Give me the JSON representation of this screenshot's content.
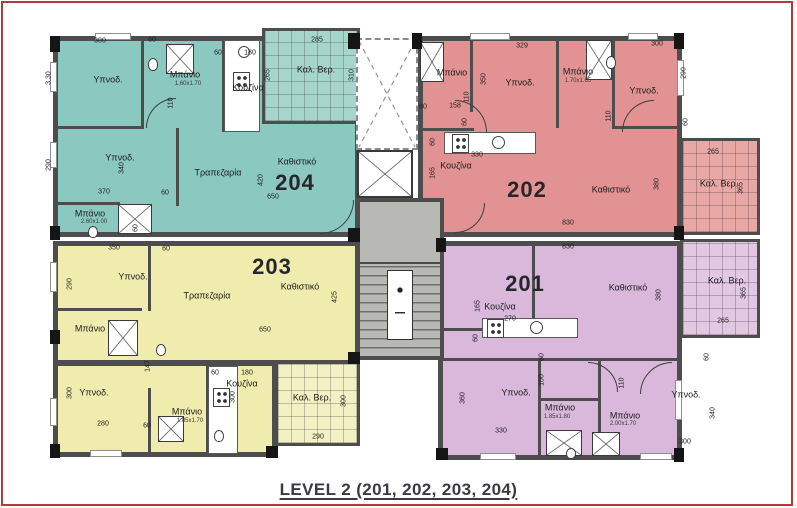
{
  "title": "LEVEL 2 (201, 202, 203, 204)",
  "colors": {
    "apt_204": "#8ac8c0",
    "bal_204": "#a6d5cb",
    "apt_202": "#e29292",
    "bal_202": "#e9a8a6",
    "apt_203": "#f0ecae",
    "bal_203": "#f3f0c4",
    "apt_201": "#d9b8db",
    "bal_201": "#e2c8e3",
    "wall": "#4d4d4d",
    "core": "#b8b8b4",
    "frame": "#b23a3a"
  },
  "apartments": [
    {
      "number": "204",
      "rooms": [
        "Υπνοδ.",
        "Υπνοδ.",
        "Μπάνιο",
        "Μπάνιο",
        "Κουζίνα",
        "Τραπεζαρία",
        "Καθιστικό",
        "Καλ. Βερ."
      ]
    },
    {
      "number": "202",
      "rooms": [
        "Μπάνιο",
        "Υπνοδ.",
        "Μπάνιο",
        "Υπνοδ.",
        "Κουζίνα",
        "Καθιστικό",
        "Καλ. Βερ."
      ]
    },
    {
      "number": "203",
      "rooms": [
        "Υπνοδ.",
        "Τραπεζαρία",
        "Καθιστικό",
        "Μπάνιο",
        "Υπνοδ.",
        "Μπάνιο",
        "Κουζίνα",
        "Καλ. Βερ."
      ]
    },
    {
      "number": "201",
      "rooms": [
        "Κουζίνα",
        "Καθιστικό",
        "Υπνοδ.",
        "Μπάνιο",
        "Μπάνιο",
        "Υπνοδ.",
        "Καλ. Βερ."
      ]
    }
  ],
  "labels": [
    {
      "t": "204",
      "x": 295,
      "y": 183,
      "c": "num"
    },
    {
      "t": "202",
      "x": 527,
      "y": 190,
      "c": "num"
    },
    {
      "t": "203",
      "x": 272,
      "y": 267,
      "c": "num"
    },
    {
      "t": "201",
      "x": 525,
      "y": 284,
      "c": "num"
    },
    {
      "t": "Υπνοδ.",
      "x": 108,
      "y": 80,
      "c": "room"
    },
    {
      "t": "Υπνοδ.",
      "x": 120,
      "y": 158,
      "c": "room"
    },
    {
      "t": "Μπάνιο",
      "x": 185,
      "y": 75,
      "c": "room"
    },
    {
      "t": "1.60x1.70",
      "x": 188,
      "y": 84,
      "c": "sub"
    },
    {
      "t": "Κουζίνα",
      "x": 248,
      "y": 88,
      "c": "room"
    },
    {
      "t": "Τραπεζαρία",
      "x": 218,
      "y": 173,
      "c": "room"
    },
    {
      "t": "Καθιστικό",
      "x": 297,
      "y": 162,
      "c": "room"
    },
    {
      "t": "Μπάνιο",
      "x": 90,
      "y": 214,
      "c": "room"
    },
    {
      "t": "2.60x1.00",
      "x": 94,
      "y": 222,
      "c": "sub"
    },
    {
      "t": "Καλ. Βερ.",
      "x": 316,
      "y": 70,
      "c": "room"
    },
    {
      "t": "Μπάνιο",
      "x": 452,
      "y": 73,
      "c": "room"
    },
    {
      "t": "Υπνοδ.",
      "x": 520,
      "y": 83,
      "c": "room"
    },
    {
      "t": "Μπάνιο",
      "x": 578,
      "y": 72,
      "c": "room"
    },
    {
      "t": "1.70x1.65",
      "x": 578,
      "y": 81,
      "c": "sub"
    },
    {
      "t": "Υπνοδ.",
      "x": 644,
      "y": 91,
      "c": "room"
    },
    {
      "t": "Κουζίνα",
      "x": 456,
      "y": 166,
      "c": "room"
    },
    {
      "t": "Καθιστικό",
      "x": 611,
      "y": 190,
      "c": "room"
    },
    {
      "t": "Καλ. Βερ.",
      "x": 719,
      "y": 184,
      "c": "room"
    },
    {
      "t": "Υπνοδ.",
      "x": 133,
      "y": 277,
      "c": "room"
    },
    {
      "t": "Τραπεζαρία",
      "x": 207,
      "y": 296,
      "c": "room"
    },
    {
      "t": "Καθιστικό",
      "x": 300,
      "y": 287,
      "c": "room"
    },
    {
      "t": "Μπάνιο",
      "x": 90,
      "y": 329,
      "c": "room"
    },
    {
      "t": "Υπνοδ.",
      "x": 94,
      "y": 393,
      "c": "room"
    },
    {
      "t": "Μπάνιο",
      "x": 187,
      "y": 412,
      "c": "room"
    },
    {
      "t": "1.85x1.70",
      "x": 190,
      "y": 421,
      "c": "sub"
    },
    {
      "t": "Κουζίνα",
      "x": 242,
      "y": 384,
      "c": "room"
    },
    {
      "t": "Καλ. Βερ.",
      "x": 312,
      "y": 398,
      "c": "room"
    },
    {
      "t": "Κουζίνα",
      "x": 500,
      "y": 307,
      "c": "room"
    },
    {
      "t": "Καθιστικό",
      "x": 628,
      "y": 288,
      "c": "room"
    },
    {
      "t": "Υπνοδ.",
      "x": 516,
      "y": 393,
      "c": "room"
    },
    {
      "t": "Μπάνιο",
      "x": 560,
      "y": 408,
      "c": "room"
    },
    {
      "t": "1.85x1.80",
      "x": 557,
      "y": 417,
      "c": "sub"
    },
    {
      "t": "Μπάνιο",
      "x": 625,
      "y": 416,
      "c": "room"
    },
    {
      "t": "2.00x1.70",
      "x": 623,
      "y": 424,
      "c": "sub"
    },
    {
      "t": "Υπνοδ.",
      "x": 686,
      "y": 395,
      "c": "room"
    },
    {
      "t": "Καλ. Βερ.",
      "x": 727,
      "y": 281,
      "c": "room"
    },
    {
      "t": "300",
      "x": 100,
      "y": 41,
      "c": "dim"
    },
    {
      "t": "60",
      "x": 152,
      "y": 40,
      "c": "dim"
    },
    {
      "t": "60",
      "x": 218,
      "y": 53,
      "c": "dim"
    },
    {
      "t": "180",
      "x": 250,
      "y": 53,
      "c": "dim"
    },
    {
      "t": "3.30",
      "x": 49,
      "y": 78,
      "c": "dim",
      "r": 1
    },
    {
      "t": "110",
      "x": 171,
      "y": 103,
      "c": "dim",
      "r": 1
    },
    {
      "t": "290",
      "x": 49,
      "y": 165,
      "c": "dim",
      "r": 1
    },
    {
      "t": "340",
      "x": 122,
      "y": 168,
      "c": "dim",
      "r": 1
    },
    {
      "t": "370",
      "x": 104,
      "y": 192,
      "c": "dim"
    },
    {
      "t": "60",
      "x": 165,
      "y": 193,
      "c": "dim"
    },
    {
      "t": "60",
      "x": 136,
      "y": 228,
      "c": "dim",
      "r": 1
    },
    {
      "t": "265",
      "x": 268,
      "y": 75,
      "c": "dim",
      "r": 1
    },
    {
      "t": "285",
      "x": 317,
      "y": 40,
      "c": "dim"
    },
    {
      "t": "310",
      "x": 352,
      "y": 75,
      "c": "dim",
      "r": 1
    },
    {
      "t": "420",
      "x": 261,
      "y": 180,
      "c": "dim",
      "r": 1
    },
    {
      "t": "650",
      "x": 273,
      "y": 197,
      "c": "dim"
    },
    {
      "t": "329",
      "x": 522,
      "y": 46,
      "c": "dim"
    },
    {
      "t": "300",
      "x": 657,
      "y": 44,
      "c": "dim"
    },
    {
      "t": "350",
      "x": 484,
      "y": 79,
      "c": "dim",
      "r": 1
    },
    {
      "t": "110",
      "x": 467,
      "y": 97,
      "c": "dim",
      "r": 1
    },
    {
      "t": "158",
      "x": 455,
      "y": 106,
      "c": "dim"
    },
    {
      "t": "60",
      "x": 423,
      "y": 107,
      "c": "dim"
    },
    {
      "t": "60",
      "x": 465,
      "y": 122,
      "c": "dim",
      "r": 1
    },
    {
      "t": "60",
      "x": 433,
      "y": 142,
      "c": "dim",
      "r": 1
    },
    {
      "t": "330",
      "x": 477,
      "y": 155,
      "c": "dim"
    },
    {
      "t": "165",
      "x": 433,
      "y": 173,
      "c": "dim",
      "r": 1
    },
    {
      "t": "110",
      "x": 609,
      "y": 116,
      "c": "dim",
      "r": 1
    },
    {
      "t": "290",
      "x": 684,
      "y": 73,
      "c": "dim",
      "r": 1
    },
    {
      "t": "60",
      "x": 686,
      "y": 122,
      "c": "dim",
      "r": 1
    },
    {
      "t": "830",
      "x": 568,
      "y": 223,
      "c": "dim"
    },
    {
      "t": "380",
      "x": 657,
      "y": 184,
      "c": "dim",
      "r": 1
    },
    {
      "t": "265",
      "x": 713,
      "y": 152,
      "c": "dim"
    },
    {
      "t": "365",
      "x": 741,
      "y": 188,
      "c": "dim",
      "r": 1
    },
    {
      "t": "350",
      "x": 114,
      "y": 248,
      "c": "dim"
    },
    {
      "t": "60",
      "x": 166,
      "y": 249,
      "c": "dim"
    },
    {
      "t": "290",
      "x": 70,
      "y": 284,
      "c": "dim",
      "r": 1
    },
    {
      "t": "650",
      "x": 265,
      "y": 330,
      "c": "dim"
    },
    {
      "t": "425",
      "x": 335,
      "y": 297,
      "c": "dim",
      "r": 1
    },
    {
      "t": "147",
      "x": 148,
      "y": 366,
      "c": "dim",
      "r": 1
    },
    {
      "t": "60",
      "x": 215,
      "y": 373,
      "c": "dim"
    },
    {
      "t": "180",
      "x": 247,
      "y": 373,
      "c": "dim"
    },
    {
      "t": "300",
      "x": 70,
      "y": 393,
      "c": "dim",
      "r": 1
    },
    {
      "t": "280",
      "x": 103,
      "y": 424,
      "c": "dim"
    },
    {
      "t": "60",
      "x": 147,
      "y": 426,
      "c": "dim"
    },
    {
      "t": "300",
      "x": 233,
      "y": 397,
      "c": "dim",
      "r": 1
    },
    {
      "t": "290",
      "x": 318,
      "y": 437,
      "c": "dim"
    },
    {
      "t": "300",
      "x": 344,
      "y": 401,
      "c": "dim",
      "r": 1
    },
    {
      "t": "830",
      "x": 568,
      "y": 247,
      "c": "dim"
    },
    {
      "t": "165",
      "x": 478,
      "y": 306,
      "c": "dim",
      "r": 1
    },
    {
      "t": "270",
      "x": 510,
      "y": 319,
      "c": "dim"
    },
    {
      "t": "380",
      "x": 659,
      "y": 295,
      "c": "dim",
      "r": 1
    },
    {
      "t": "60",
      "x": 476,
      "y": 338,
      "c": "dim",
      "r": 1
    },
    {
      "t": "60",
      "x": 542,
      "y": 357,
      "c": "dim",
      "r": 1
    },
    {
      "t": "60",
      "x": 707,
      "y": 357,
      "c": "dim",
      "r": 1
    },
    {
      "t": "100",
      "x": 542,
      "y": 380,
      "c": "dim",
      "r": 1
    },
    {
      "t": "110",
      "x": 622,
      "y": 383,
      "c": "dim",
      "r": 1
    },
    {
      "t": "360",
      "x": 463,
      "y": 398,
      "c": "dim",
      "r": 1
    },
    {
      "t": "330",
      "x": 501,
      "y": 431,
      "c": "dim"
    },
    {
      "t": "340",
      "x": 713,
      "y": 413,
      "c": "dim",
      "r": 1
    },
    {
      "t": "300",
      "x": 685,
      "y": 442,
      "c": "dim"
    },
    {
      "t": "365",
      "x": 744,
      "y": 293,
      "c": "dim",
      "r": 1
    },
    {
      "t": "265",
      "x": 723,
      "y": 321,
      "c": "dim"
    }
  ]
}
